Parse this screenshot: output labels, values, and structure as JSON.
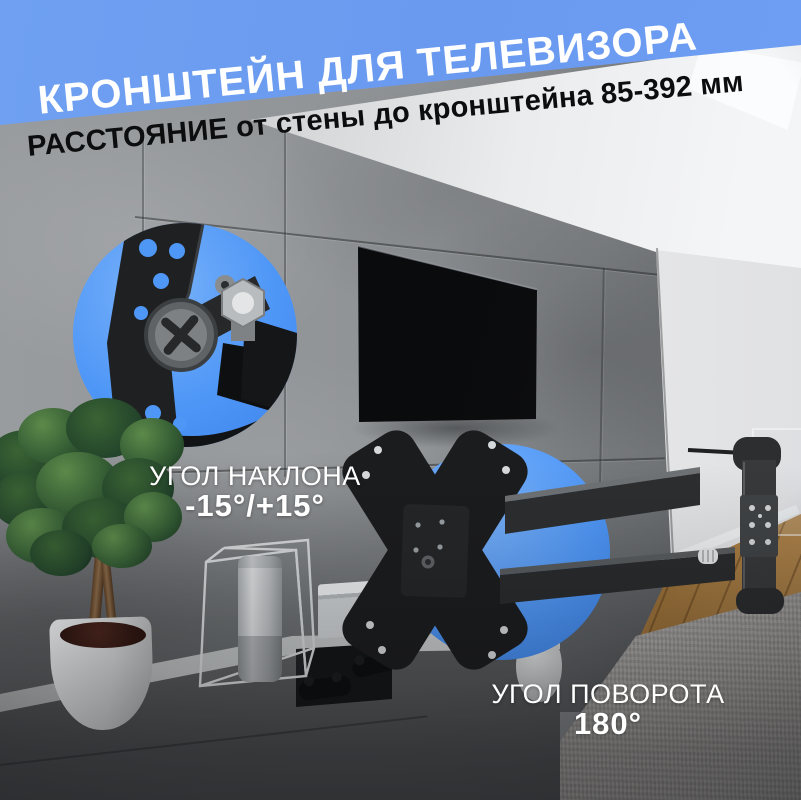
{
  "image_type": "product-marketing-photo",
  "banner": {
    "title": "КРОНШТЕЙН ДЛЯ ТЕЛЕВИЗОРА",
    "background_color": "#6f9ff2",
    "text_color": "#ffffff"
  },
  "subtitle": {
    "text": "РАССТОЯНИЕ от стены до кронштейна 85-392 мм",
    "text_color": "#0c0d0e"
  },
  "callouts": {
    "tilt": {
      "label": "УГОЛ НАКЛОНА",
      "value": "-15°/+15°",
      "circle_color": "#4f97f7"
    },
    "swivel": {
      "label": "УГОЛ ПОВОРОТА",
      "value": "180°",
      "circle_color": "#4f97f7"
    }
  }
}
